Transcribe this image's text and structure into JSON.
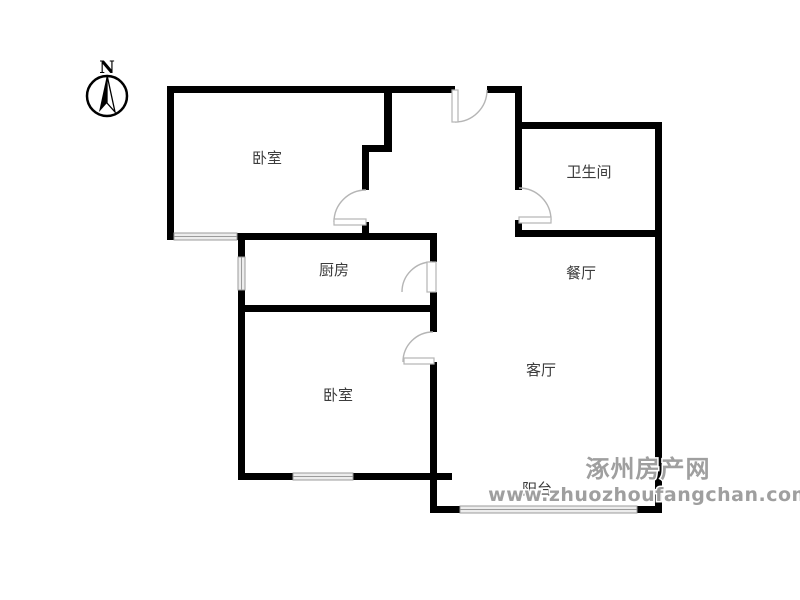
{
  "page": {
    "background": "#ffffff"
  },
  "floorplan": {
    "canvas": {
      "width": 800,
      "height": 600
    },
    "colors": {
      "wall": "#000000",
      "door": "#b5b5b5",
      "door_leaf_fill": "#ffffff",
      "window_fill": "#ededed",
      "window_stroke": "#9b9b9b",
      "label": "#3c3c3c"
    },
    "rooms": [
      {
        "id": "bedroom-1",
        "label": "卧室",
        "x": 267,
        "y": 163
      },
      {
        "id": "bathroom",
        "label": "卫生间",
        "x": 589,
        "y": 177
      },
      {
        "id": "kitchen",
        "label": "厨房",
        "x": 334,
        "y": 275
      },
      {
        "id": "dining-room",
        "label": "餐厅",
        "x": 581,
        "y": 278
      },
      {
        "id": "living-room",
        "label": "客厅",
        "x": 541,
        "y": 375
      },
      {
        "id": "bedroom-2",
        "label": "卧室",
        "x": 338,
        "y": 400
      },
      {
        "id": "balcony",
        "label": "阳台",
        "x": 537,
        "y": 494
      }
    ],
    "walls": [
      {
        "x": 167,
        "y": 86,
        "w": 288,
        "h": 7
      },
      {
        "x": 487,
        "y": 86,
        "w": 35,
        "h": 7
      },
      {
        "x": 167,
        "y": 86,
        "w": 7,
        "h": 154
      },
      {
        "x": 237,
        "y": 233,
        "w": 200,
        "h": 7
      },
      {
        "x": 384,
        "y": 86,
        "w": 8,
        "h": 66
      },
      {
        "x": 362,
        "y": 145,
        "w": 30,
        "h": 7
      },
      {
        "x": 362,
        "y": 145,
        "w": 7,
        "h": 45
      },
      {
        "x": 362,
        "y": 222,
        "w": 7,
        "h": 18
      },
      {
        "x": 515,
        "y": 86,
        "w": 7,
        "h": 104
      },
      {
        "x": 515,
        "y": 220,
        "w": 7,
        "h": 17
      },
      {
        "x": 515,
        "y": 122,
        "w": 147,
        "h": 7
      },
      {
        "x": 515,
        "y": 230,
        "w": 147,
        "h": 7
      },
      {
        "x": 655,
        "y": 122,
        "w": 7,
        "h": 391
      },
      {
        "x": 238,
        "y": 240,
        "w": 7,
        "h": 17
      },
      {
        "x": 238,
        "y": 290,
        "w": 7,
        "h": 183
      },
      {
        "x": 238,
        "y": 305,
        "w": 199,
        "h": 7
      },
      {
        "x": 430,
        "y": 233,
        "w": 7,
        "h": 29
      },
      {
        "x": 430,
        "y": 292,
        "w": 7,
        "h": 40
      },
      {
        "x": 430,
        "y": 362,
        "w": 7,
        "h": 111
      },
      {
        "x": 238,
        "y": 473,
        "w": 55,
        "h": 7
      },
      {
        "x": 353,
        "y": 473,
        "w": 99,
        "h": 7
      },
      {
        "x": 430,
        "y": 473,
        "w": 7,
        "h": 40
      },
      {
        "x": 437,
        "y": 506,
        "w": 23,
        "h": 7
      },
      {
        "x": 637,
        "y": 506,
        "w": 25,
        "h": 7
      }
    ],
    "windows": [
      {
        "id": "bedroom-1-window",
        "x": 174,
        "y": 233,
        "w": 63,
        "h": 7,
        "orient": "h"
      },
      {
        "id": "kitchen-window",
        "x": 238,
        "y": 257,
        "w": 7,
        "h": 33,
        "orient": "v"
      },
      {
        "id": "bedroom-2-window",
        "x": 293,
        "y": 473,
        "w": 60,
        "h": 7,
        "orient": "h"
      },
      {
        "id": "balcony-window",
        "x": 460,
        "y": 506,
        "w": 177,
        "h": 7,
        "orient": "h"
      }
    ],
    "doors": [
      {
        "id": "entrance-door",
        "arc": "M 487 90 A 32 32 0 0 1 455 122",
        "leaf": {
          "x": 452,
          "y": 90,
          "w": 6,
          "h": 32
        }
      },
      {
        "id": "bedroom-1-door",
        "arc": "M 366 190 A 32 32 0 0 0 334 222",
        "leaf": {
          "x": 334,
          "y": 219,
          "w": 32,
          "h": 6
        }
      },
      {
        "id": "bathroom-door",
        "arc": "M 519 188 A 32 32 0 0 1 551 220",
        "leaf": {
          "x": 519,
          "y": 217,
          "w": 32,
          "h": 6
        }
      },
      {
        "id": "kitchen-door",
        "arc": "M 432 262 A 30 30 0 0 0 402 292",
        "leaf": {
          "x": 427,
          "y": 262,
          "w": 9,
          "h": 30
        }
      },
      {
        "id": "bedroom-2-door",
        "arc": "M 433 332 A 30 30 0 0 0 403 362",
        "leaf": {
          "x": 404,
          "y": 358,
          "w": 30,
          "h": 6
        }
      }
    ]
  },
  "compass": {
    "label": "N",
    "cx": 107,
    "cy": 96,
    "r": 20
  },
  "watermark": {
    "line1": "涿州房产网",
    "line2": "www.zhuozhoufangchan.com",
    "x1": 648,
    "y1": 477,
    "x2": 650,
    "y2": 501,
    "color": "#9f9f9f",
    "outline": "#ffffff"
  }
}
